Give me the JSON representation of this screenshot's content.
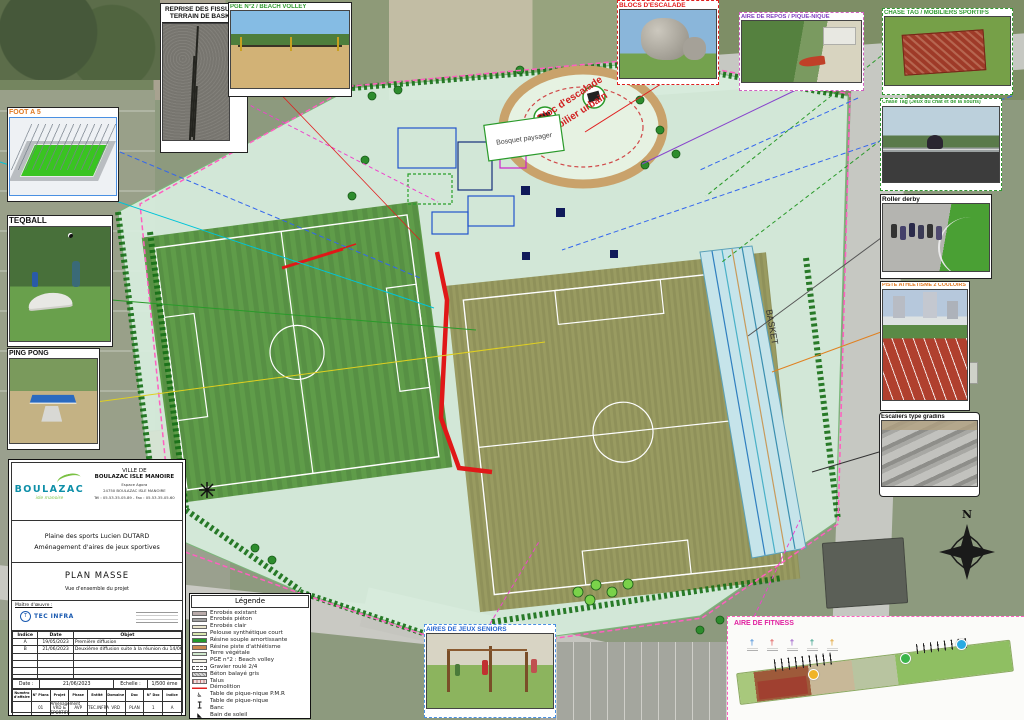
{
  "plan": {
    "bloc_escalade": "Bloc d'escalade",
    "mobilier_urbain": "Mobilier urbain",
    "bosquet": "Bosquet paysager",
    "basket": "BASKET",
    "compass_n": "N"
  },
  "insets": {
    "fissures": {
      "label_line1": "REPRISE DES FISSURES",
      "label_line2": "TERRAIN DE BASKET"
    },
    "beach_volley": {
      "label": "PGE N°2 / BEACH VOLLEY"
    },
    "foot_a5": {
      "label": "FOOT A 5"
    },
    "teqball": {
      "label": "TEQBALL"
    },
    "ping_pong": {
      "label": "PING PONG"
    },
    "blocs_escalade": {
      "label": "BLOCS D'ESCALADE"
    },
    "aire_repos": {
      "label": "AIRE DE REPOS / PIQUE-NIQUE"
    },
    "chase_tag_aerial": {
      "label": "CHASE TAG / MOBILIERS SPORTIFS"
    },
    "chase_tag_photo": {
      "label": "Chase Tag (Jeux du chat et de la souris)"
    },
    "roller_derby": {
      "label": "Roller derby"
    },
    "piste_athletisme": {
      "label": "PISTE ATHLETISME 2 COULOIRS"
    },
    "escaliers": {
      "label": "Escaliers type gradins"
    },
    "jeux_seniors": {
      "label": "AIRES DE JEUX SENIORS"
    },
    "fitness": {
      "label": "AIRE DE FITNESS"
    }
  },
  "title_block": {
    "logo_text": "BOULAZAC",
    "logo_sub": "isle manoire",
    "ville_line1": "VILLE DE",
    "ville_line2": "BOULAZAC ISLE MANOIRE",
    "address_line1": "Espace Agora",
    "address_line2": "24750 BOULAZAC ISLE MANOIRE",
    "address_line3": "Tél : 05.53.35.05.89  -  Fax : 05.53.35.05.60",
    "project_line1": "Plaine des sports Lucien DUTARD",
    "project_line2": "Aménagement d'aires de jeux sportives",
    "doc_title": "PLAN MASSE",
    "doc_subtitle": "Vue d'ensemble du projet",
    "moe_label": "Maître d'œuvre :",
    "moe_logo_text": "T",
    "moe_name": "TEC INFRA",
    "revisions_headers": [
      "Indice",
      "Date",
      "Objet"
    ],
    "revisions": [
      {
        "indice": "A",
        "date": "19/05/2023",
        "objet": "Première diffusion"
      },
      {
        "indice": "B",
        "date": "21/06/2023",
        "objet": "Deuxième diffusion suite à la réunion du 14/06/2023"
      }
    ],
    "date_label": "Date :",
    "date_value": "21/06/2023",
    "echelle_label": "Echelle :",
    "echelle_value": "1/500 ème",
    "grid_headers": [
      "Numéro d'affaire",
      "N° Plans",
      "Projet",
      "Phase",
      "Entité",
      "Domaine",
      "Doc",
      "N° Doc",
      "Indice"
    ],
    "grid_values": [
      "",
      "01",
      "Aménagement VRD & SPORTIFS",
      "AVP",
      "TEC.INFRA",
      "VRD",
      "PLAN",
      "1",
      "A"
    ]
  },
  "legend": {
    "title": "Légende",
    "items": [
      {
        "label": "Enrobés existant",
        "kind": "swatch",
        "color": "#b9abaa"
      },
      {
        "label": "Enrobés piéton",
        "kind": "swatch",
        "color": "#9e9e9e"
      },
      {
        "label": "Enrobés clair",
        "kind": "swatch",
        "color": "#eae6cd"
      },
      {
        "label": "Pelouse synthétique court",
        "kind": "swatch",
        "color": "#d9e8b0"
      },
      {
        "label": "Résine souple amortissante",
        "kind": "swatch",
        "color": "#22992b"
      },
      {
        "label": "Résine piste d'athlétisme",
        "kind": "swatch",
        "color": "#c9874f"
      },
      {
        "label": "Terre végétale",
        "kind": "swatch",
        "color": "#cfe8cd"
      },
      {
        "label": "PGE n°2 : Beach volley",
        "kind": "swatch",
        "color": "#f4f2e4"
      },
      {
        "label": "Gravier roulé 2/4",
        "kind": "dashed",
        "color": "#ffffff"
      },
      {
        "label": "Béton balayé gris",
        "kind": "texture",
        "color": "#d8d8d8"
      },
      {
        "label": "Talus",
        "kind": "talus",
        "color": "#f0dede"
      },
      {
        "label": "Démolition",
        "kind": "line",
        "color": "#e02020"
      },
      {
        "label": "Table de pique-nique P.M.R",
        "kind": "icon",
        "glyph": "♿"
      },
      {
        "label": "Table de pique-nique",
        "kind": "icon",
        "glyph": "┳"
      },
      {
        "label": "Banc",
        "kind": "icon",
        "glyph": "┻"
      },
      {
        "label": "Bain de soleil",
        "kind": "icon",
        "glyph": "◣"
      }
    ]
  },
  "colors": {
    "boundary_pink": "#ff5fc0",
    "demolition_red": "#e01818",
    "synthetic_pitch": "#5f9c49",
    "grass_pitch": "#8f915a",
    "track_band": "#c6e4ea",
    "oval_track": "#c9a26b"
  }
}
